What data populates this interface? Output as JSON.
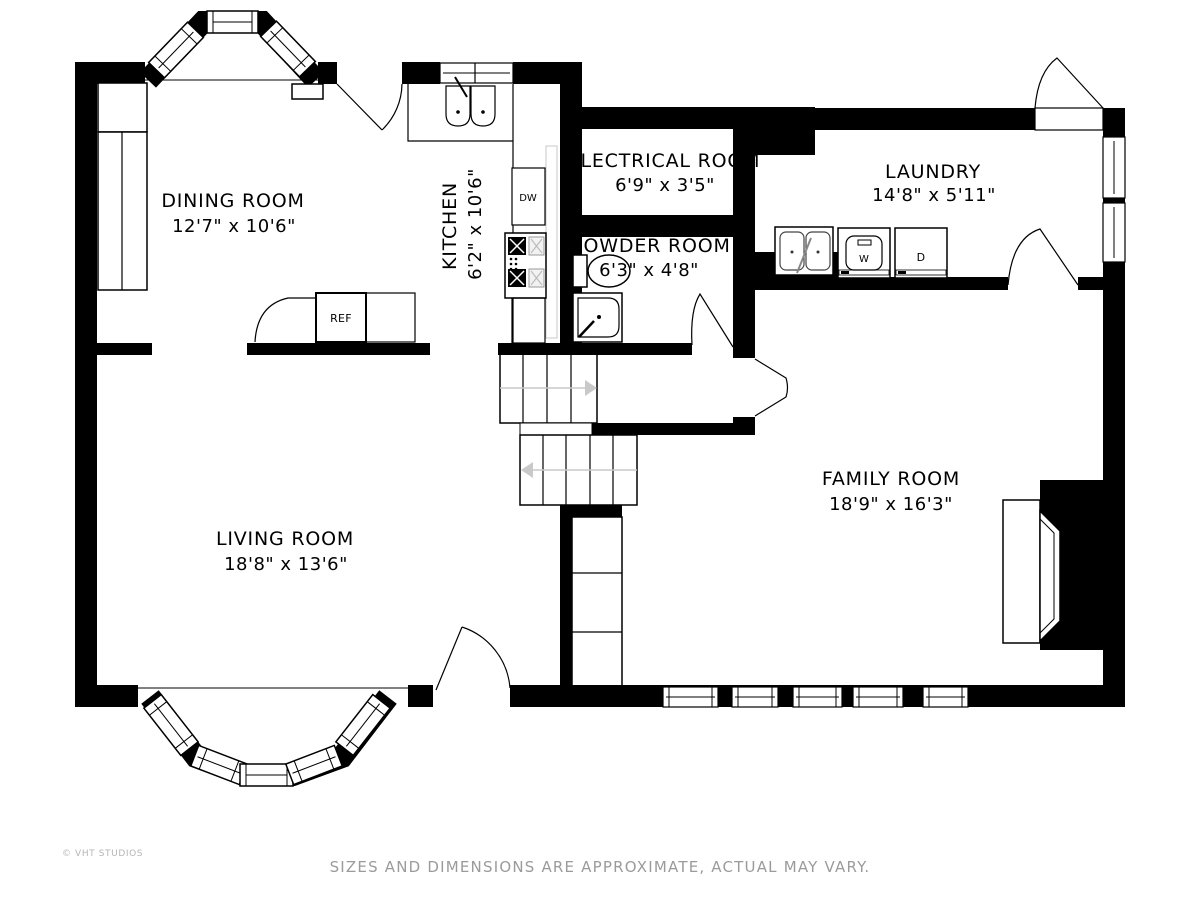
{
  "rooms": [
    {
      "name": "DINING ROOM",
      "dims": "12'7\" x 10'6\""
    },
    {
      "name": "KITCHEN",
      "dims": "6'2\" x 10'6\""
    },
    {
      "name": "ELECTRICAL ROOM",
      "dims": "6'9\" x 3'5\""
    },
    {
      "name": "LAUNDRY",
      "dims": "14'8\" x 5'11\""
    },
    {
      "name": "POWDER ROOM",
      "dims": "6'3\" x 4'8\""
    },
    {
      "name": "LIVING ROOM",
      "dims": "18'8\" x 13'6\""
    },
    {
      "name": "FAMILY ROOM",
      "dims": "18'9\" x 16'3\""
    }
  ],
  "appliances": {
    "dishwasher": "DW",
    "refrigerator": "REF",
    "washer": "W",
    "dryer": "D"
  },
  "footer": {
    "copyright": "© VHT STUDIOS",
    "disclaimer": "SIZES AND DIMENSIONS ARE APPROXIMATE, ACTUAL MAY VARY."
  },
  "colors": {
    "wall": "#000000",
    "background": "#ffffff",
    "muted_text": "#9b9b9b",
    "stair_arrow": "#c9c9c9"
  }
}
